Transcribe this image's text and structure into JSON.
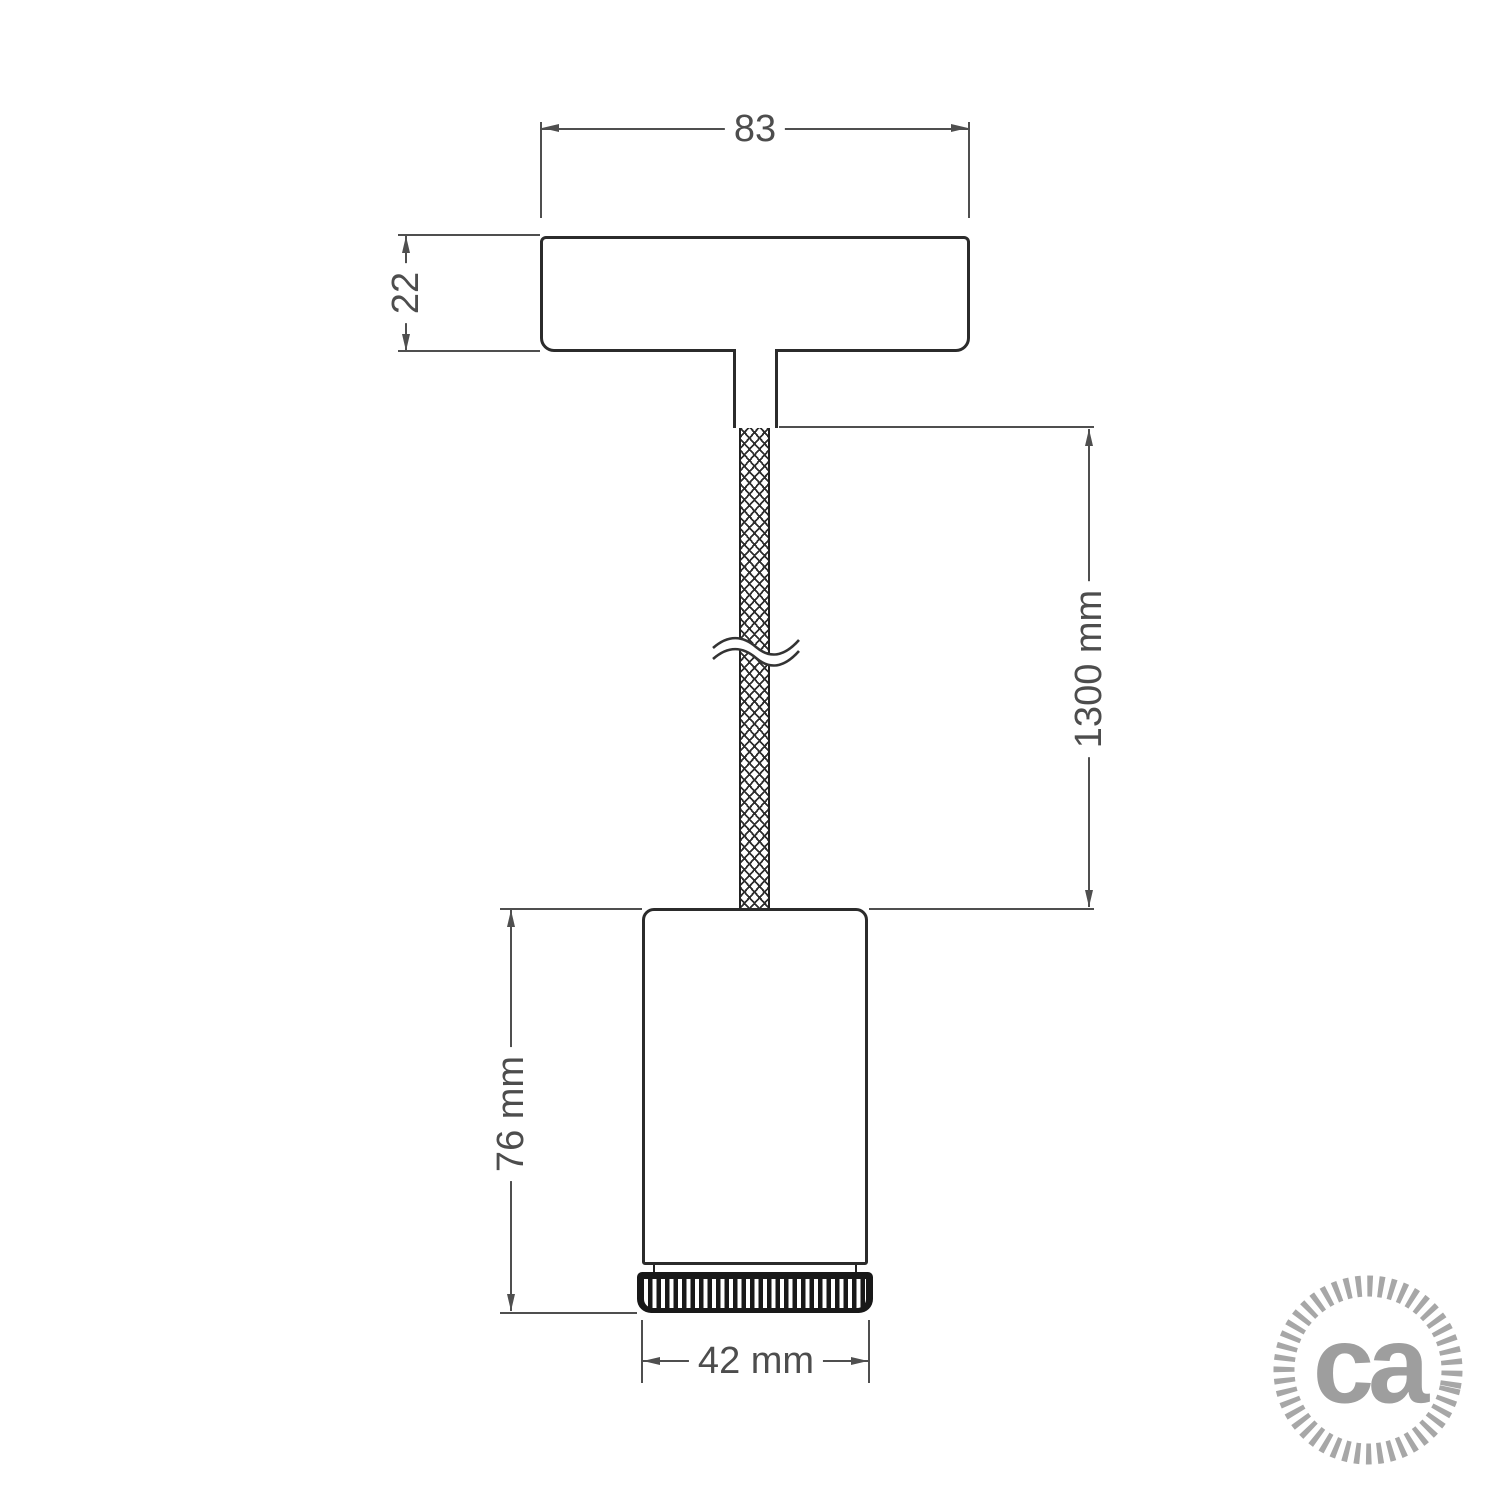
{
  "drawing": {
    "title": "pendant-lamp-technical-drawing",
    "dimensions": {
      "canopy_width": "83",
      "canopy_height": "22",
      "cable_length": "1300 mm",
      "spotlight_height": "76 mm",
      "spotlight_diameter": "42 mm"
    },
    "colors": {
      "outline": "#2b2b2b",
      "dimension_lines": "#4f4f4f",
      "dimension_text": "#4d4d4d",
      "bezel_fill": "#181818",
      "logo_gray": "#a7a7a7"
    }
  },
  "logo": {
    "text": "ca"
  }
}
